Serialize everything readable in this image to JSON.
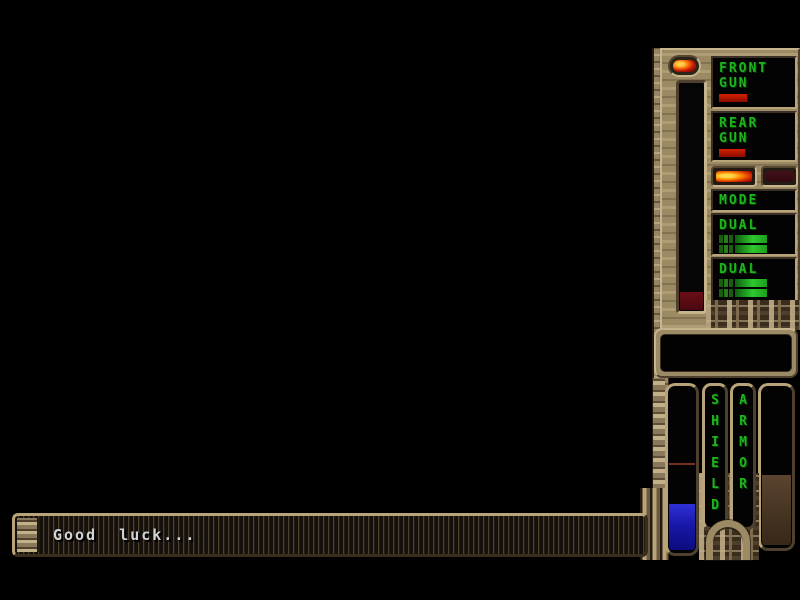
{
  "game": {
    "name": "space-shooter-hud",
    "message_bar": {
      "text": "Good  luck..."
    },
    "weapons_panel": {
      "front_gun": {
        "label": "FRONT\nGUN",
        "power_pct": "34%"
      },
      "rear_gun": {
        "label": "REAR\nGUN",
        "power_pct": "32%"
      },
      "mode": {
        "label": "MODE",
        "left_light": "on",
        "right_light": "off"
      },
      "dual_top": {
        "label": "DUAL",
        "bar1_fill": "42%",
        "bar2_fill": "42%"
      },
      "dual_bottom": {
        "label": "DUAL",
        "bar1_fill": "42%",
        "bar2_fill": "42%"
      },
      "generator_gauge": {
        "fill_pct": "8%"
      }
    },
    "gauges": {
      "shield": {
        "label": "S\nH\nI\nE\nL\nD",
        "fill_pct": "28%",
        "marker_from_top": "46%"
      },
      "armor": {
        "label": "A\nR\nM\nO\nR",
        "fill_pct": "44%"
      }
    },
    "data_display": {
      "value": ""
    },
    "colors": {
      "hud_green": "#1db41d",
      "panel_tan": "#9c8a64",
      "indicator_red": "#b01400",
      "shield_blue": "#2020c8",
      "armor_brown": "#463422",
      "message_text": "#d4d4d4",
      "background": "#000000"
    }
  }
}
